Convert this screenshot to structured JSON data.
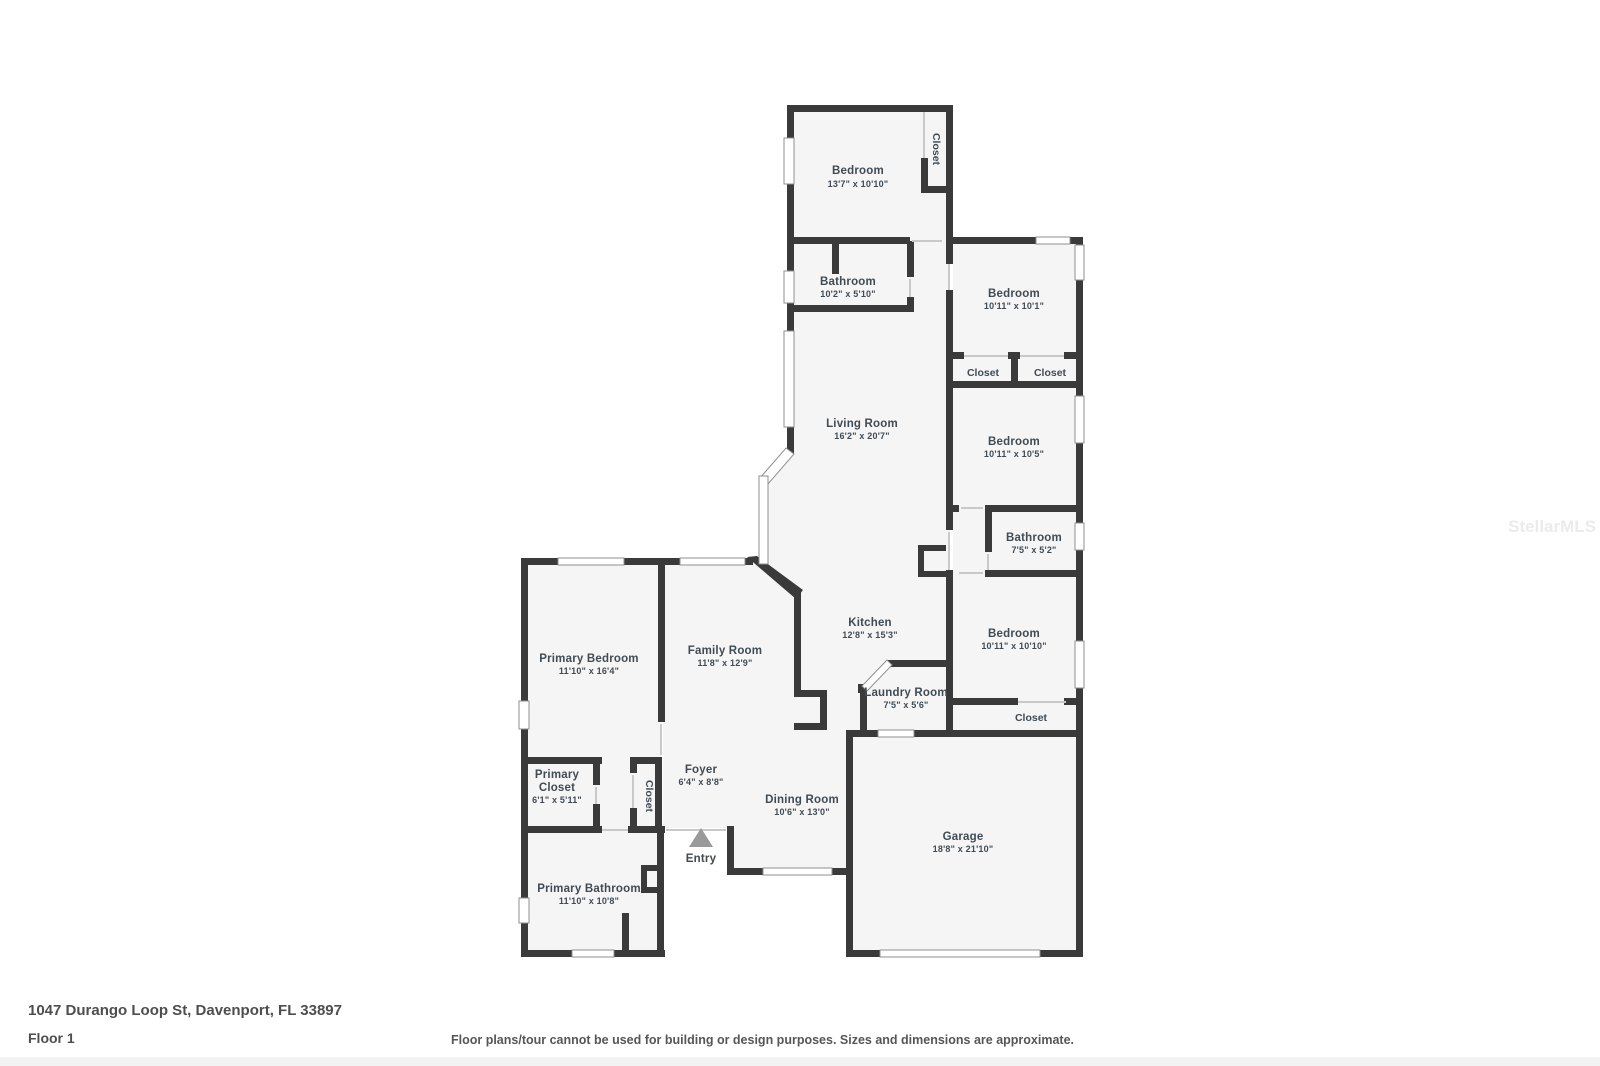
{
  "page": {
    "address": "1047 Durango Loop St, Davenport, FL 33897",
    "floor_label": "Floor 1",
    "disclaimer": "Floor plans/tour cannot be used for building or design purposes. Sizes and dimensions are approximate.",
    "watermark": "StellarMLS"
  },
  "colors": {
    "wall": "#3a3a3a",
    "room_fill": "#f5f5f6",
    "label_text": "#414b53",
    "window_stroke": "#8f8f8f",
    "entry_arrow": "#9a9a9a"
  },
  "rooms": {
    "bedroom_top": {
      "label": "Bedroom",
      "dims": "13'7\" x 10'10\""
    },
    "closet_top": {
      "label": "Closet"
    },
    "bathroom_top": {
      "label": "Bathroom",
      "dims": "10'2\" x 5'10\""
    },
    "living_room": {
      "label": "Living Room",
      "dims": "16'2\" x 20'7\""
    },
    "bedroom_ne": {
      "label": "Bedroom",
      "dims": "10'11\" x 10'1\""
    },
    "closet_left": {
      "label": "Closet"
    },
    "closet_right": {
      "label": "Closet"
    },
    "bedroom_e": {
      "label": "Bedroom",
      "dims": "10'11\" x 10'5\""
    },
    "bathroom_e": {
      "label": "Bathroom",
      "dims": "7'5\" x 5'2\""
    },
    "bedroom_se": {
      "label": "Bedroom",
      "dims": "10'11\" x 10'10\""
    },
    "closet_se": {
      "label": "Closet"
    },
    "kitchen": {
      "label": "Kitchen",
      "dims": "12'8\" x 15'3\""
    },
    "laundry": {
      "label": "Laundry Room",
      "dims": "7'5\" x 5'6\""
    },
    "garage": {
      "label": "Garage",
      "dims": "18'8\" x 21'10\""
    },
    "dining": {
      "label": "Dining Room",
      "dims": "10'6\" x 13'0\""
    },
    "family": {
      "label": "Family Room",
      "dims": "11'8\" x 12'9\""
    },
    "primary_bedroom": {
      "label": "Primary Bedroom",
      "dims": "11'10\" x 16'4\""
    },
    "primary_closet": {
      "label1": "Primary",
      "label2": "Closet",
      "dims": "6'1\" x 5'11\""
    },
    "closet_foyer": {
      "label": "Closet"
    },
    "foyer": {
      "label": "Foyer",
      "dims": "6'4\" x 8'8\""
    },
    "primary_bathroom": {
      "label": "Primary Bathroom",
      "dims": "11'10\" x 10'8\""
    },
    "entry": {
      "label": "Entry"
    }
  }
}
